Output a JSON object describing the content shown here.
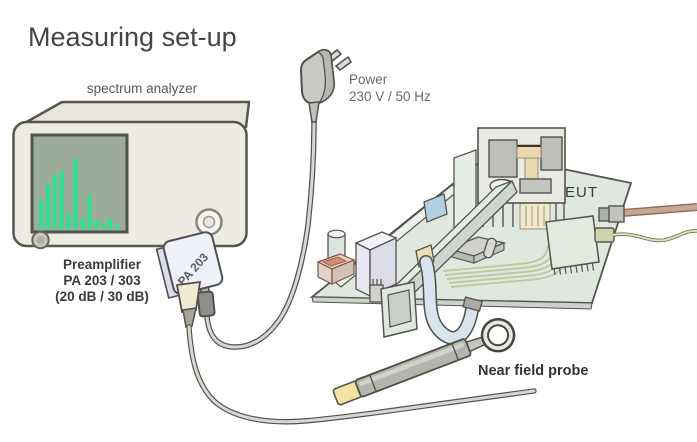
{
  "title": "Measuring set-up",
  "analyzer": {
    "label": "spectrum analyzer",
    "screen_bg": "#9cab9c",
    "bar_color": "#2ee18c",
    "screen_bars_pct": [
      34,
      52,
      62,
      66,
      18,
      80,
      12,
      38,
      10,
      7,
      12,
      5
    ]
  },
  "power": {
    "line1": "Power",
    "line2": "230 V / 50 Hz"
  },
  "preamp": {
    "device_label": "PA 203",
    "caption_line1": "Preamplifier",
    "caption_line2": "PA 203 / 303",
    "caption_line3": "(20 dB / 30 dB)"
  },
  "eut": {
    "label": "EUT"
  },
  "probe": {
    "label": "Near field probe"
  },
  "colors": {
    "analyzer_body": "#edebe2",
    "outline": "#54544e",
    "board_green": "#e0e7de",
    "ribbon_blue": "#d6e5ee",
    "tan_cable": "#c7a794",
    "signal_cable_green": "#dfe2ac",
    "preamp_body": "#eff1f8",
    "probe_band_yellow": "#f3e3a4",
    "cable_core": "#d8d8d2"
  }
}
